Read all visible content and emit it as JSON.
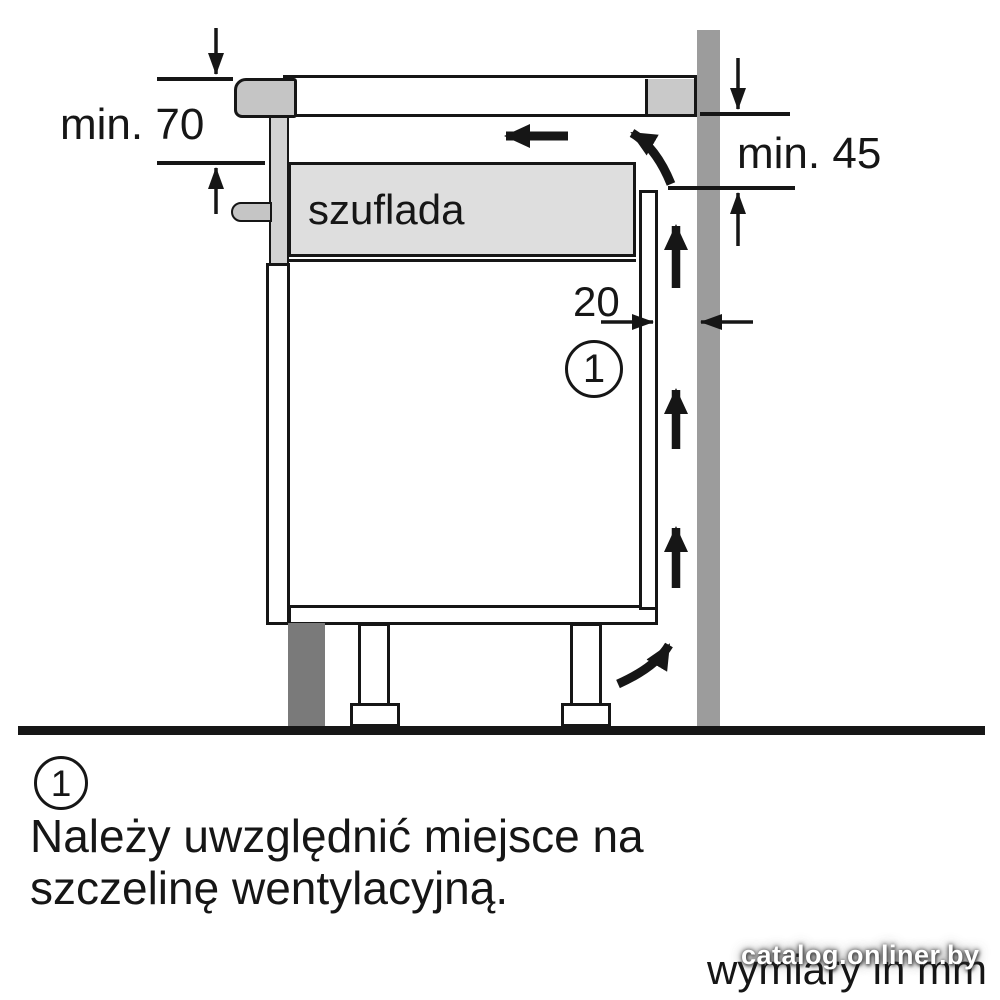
{
  "figure": {
    "drawer_label": "szuflada",
    "dim_top_clearance": "min. 70",
    "dim_back_clearance": "min. 45",
    "dim_gap": "20",
    "callout": "1"
  },
  "note": {
    "marker": "1",
    "lines": [
      "Należy uwzględnić miejsce na",
      "szczelinę wentylacyjną."
    ]
  },
  "footer": {
    "units_label": "wymiary in mm",
    "watermark": "catalog.onliner.by"
  },
  "colors": {
    "line": "#161616",
    "wall": "#9c9c9c",
    "hob_edge": "#c5c5c5",
    "worktop_block": "#c9c9c9",
    "front_trim": "#d2d2d2",
    "drawer_fill": "#dedede",
    "plinth": "#7a7a7a",
    "background": "#ffffff",
    "watermark_text": "#ffffff"
  }
}
